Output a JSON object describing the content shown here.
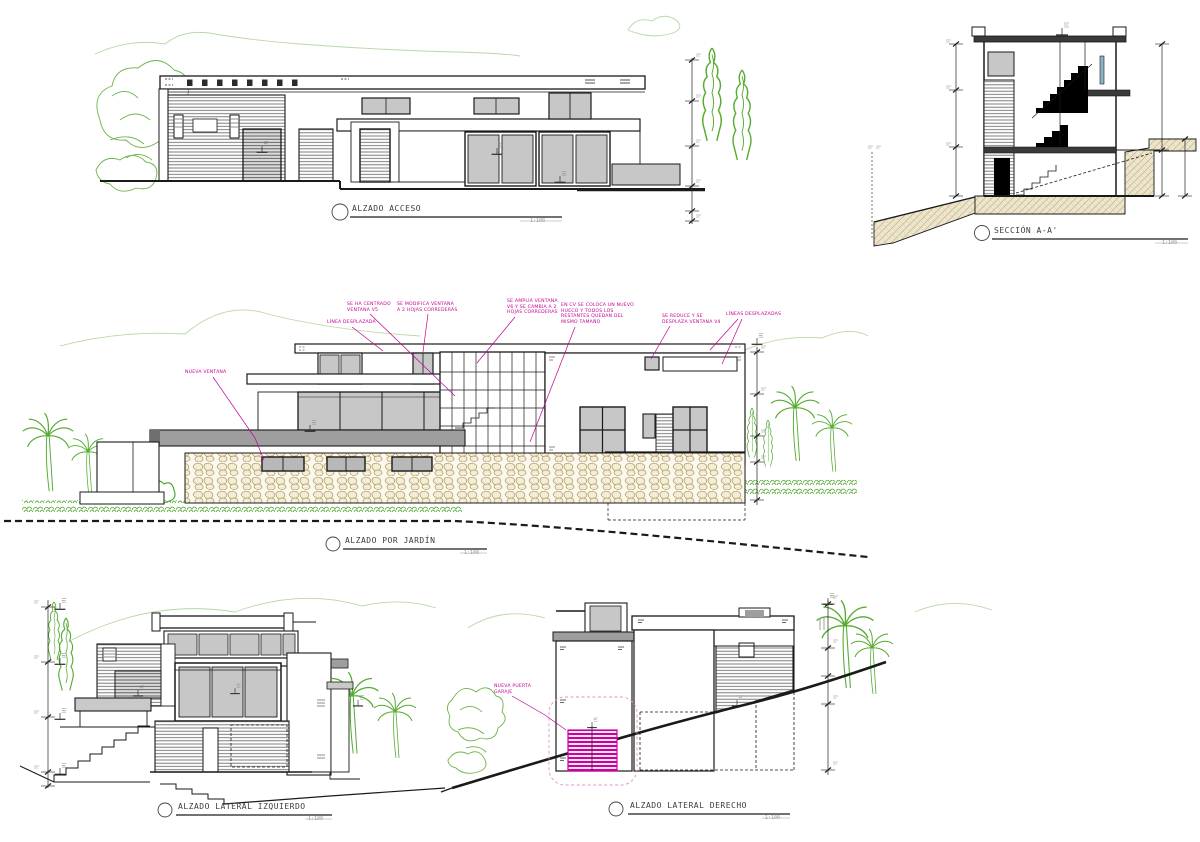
{
  "sheet": {
    "background": "#ffffff"
  },
  "palette": {
    "line": "#1a1a1a",
    "glazing": "#c7c7c7",
    "slab_gray": "#9e9e9e",
    "vegetation": "#6fb44c",
    "vegetation_bright": "#3fa51e",
    "stone_outline": "#b09a55",
    "ground_hatch": "#ede6cf",
    "annotation_magenta": "#c2008f",
    "garage_highlight": "#cc00a0"
  },
  "views": {
    "access": {
      "title": "ALZADO ACCESO",
      "scale": "1:100"
    },
    "section": {
      "title": "SECCIÓN A-A'",
      "scale": "1:100"
    },
    "garden": {
      "title": "ALZADO POR JARDÍN",
      "scale": "1:100"
    },
    "lateral_left": {
      "title": "ALZADO LATERAL IZQUIERDO",
      "scale": "1:100"
    },
    "lateral_right": {
      "title": "ALZADO LATERAL DERECHO",
      "scale": "1:100"
    }
  },
  "annotations": {
    "garden": [
      {
        "id": "linea-desplazada",
        "text": "LÍNEA DESPLAZADA"
      },
      {
        "id": "centrado-v5",
        "text": "SE HA CENTRADO\nVENTANA V5"
      },
      {
        "id": "modifica-ventana",
        "text": "SE MODIFICA VENTANA\nA 2 HOJAS CORREDERAS"
      },
      {
        "id": "amplia-v6",
        "text": "SE AMPLIA VENTANA\nV6 Y SE CAMBIA A 2\nHOJAS CORREDERAS"
      },
      {
        "id": "cv-nuevo-hueco",
        "text": "EN CV SE COLOCA UN NUEVO\nHUECO Y TODOS LOS\nRESTANTES QUEDAN DEL\nMISMO TAMAÑO"
      },
      {
        "id": "reduce-v4",
        "text": "SE REDUCE Y SE\nDESPLAZA VENTANA V4"
      },
      {
        "id": "lineas-desplazadas",
        "text": "LÍNEAS DESPLAZADAS"
      },
      {
        "id": "nueva-ventana",
        "text": "NUEVA VENTANA"
      }
    ],
    "lateral_right": [
      {
        "id": "nueva-puerta-garaje",
        "text": "NUEVA PUERTA\nGARAJE"
      }
    ]
  }
}
